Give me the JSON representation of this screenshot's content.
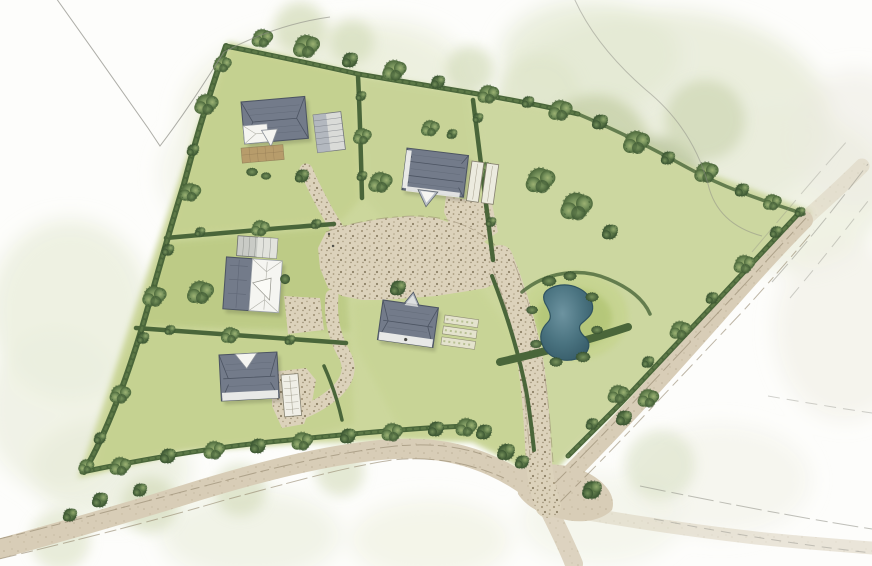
{
  "scene": {
    "style": "hand-painted watercolour aerial site plan of a small rural housing scheme",
    "houses": [
      {
        "name": "house-northwest",
        "description": "detached house, grey hipped roof, white porch, brown paved terrace, striped carport beside"
      },
      {
        "name": "house-northeast",
        "description": "detached house, grey ridged roof, white gable porch, twin garage bays beside"
      },
      {
        "name": "house-west",
        "description": "L-shaped house, slate and white roof, striped barn outbuilding at its top"
      },
      {
        "name": "house-central",
        "description": "detached house, grey roof with projecting front gable, garden beds beside"
      },
      {
        "name": "house-southwest",
        "description": "detached house, grey roof with white gable notch, long white outbuilding beside"
      }
    ],
    "landscape": {
      "pond": "kidney-shaped pond ringed by shrubs inside a round grass enclosure",
      "courtyard": "central shared gravel courtyard with branching gravel drives to each house",
      "lane": "tree-lined country lane along the south-west boundary",
      "road": "road along the north-east boundary running down to a junction at the south-east",
      "boundaries": "dark hedgerows with hedgerow trees dividing the site into five paddocks",
      "beyond": "soft sage tree masses and open field washes fading out to white paper"
    }
  },
  "palette": {
    "paper": "#fdfdfb",
    "wash_pale": "#edefdf",
    "wash_sage": "#dde3cb",
    "canopy_sage": "#c3cda6",
    "field_light": "#ccd79c",
    "field_mid": "#c2cf8b",
    "field_dark": "#b7c77e",
    "field_east": "#cdd7a4",
    "hedge_dark": "#4a663a",
    "hedge_mid": "#5f7b49",
    "tree_light": "#9db273",
    "tree_mid": "#74905a",
    "tree_dark": "#4c683b",
    "tree_deep": "#3a5531",
    "roof_grey": "#737b8a",
    "roof_dark": "#4c5462",
    "roof_light": "#a9afb9",
    "wall_white": "#f5f5f1",
    "terrace_brown": "#b59062",
    "gravel_tan": "#dcd2bb",
    "gravel_dot": "#9c8f73",
    "road_tan": "#d8cdb7",
    "road_edge": "#93866d",
    "pond_light": "#6d93a0",
    "pond_blue": "#4a7380",
    "pond_deep": "#2f5360",
    "pencil_grey": "#8c8c84"
  }
}
